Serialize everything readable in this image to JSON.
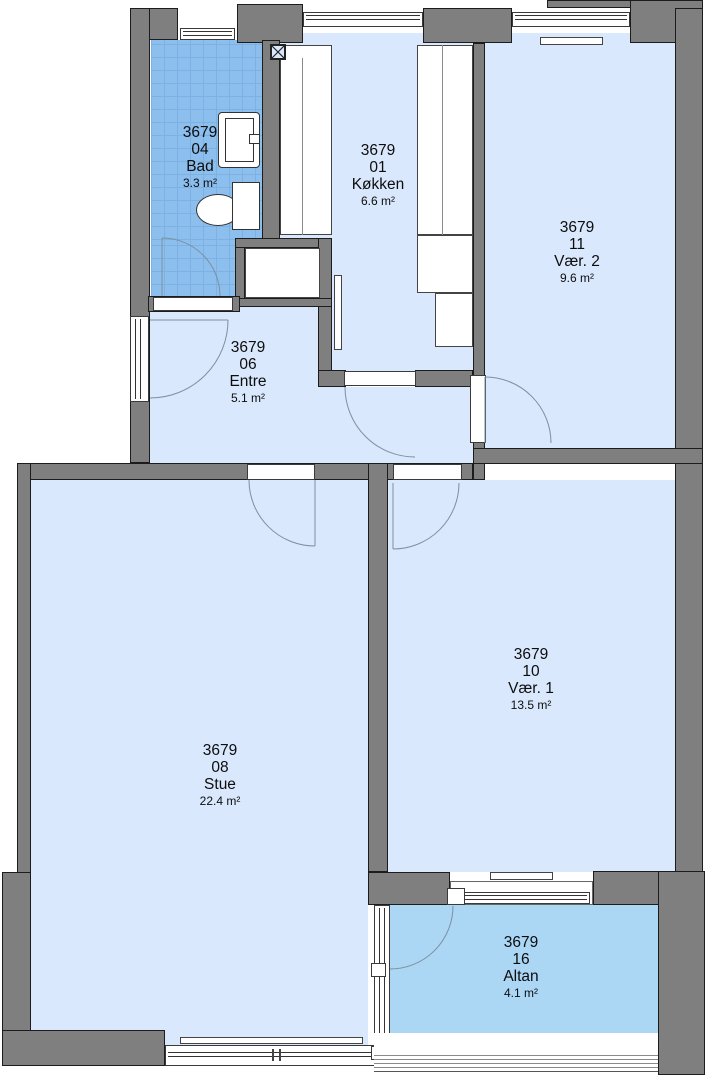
{
  "plan": {
    "unit_number": "3679",
    "rooms": {
      "bad": {
        "project": "3679",
        "number": "04",
        "name": "Bad",
        "area": "3.3 m²"
      },
      "kokken": {
        "project": "3679",
        "number": "01",
        "name": "Køkken",
        "area": "6.6 m²"
      },
      "vaer2": {
        "project": "3679",
        "number": "11",
        "name": "Vær. 2",
        "area": "9.6 m²"
      },
      "entre": {
        "project": "3679",
        "number": "06",
        "name": "Entre",
        "area": "5.1 m²"
      },
      "stue": {
        "project": "3679",
        "number": "08",
        "name": "Stue",
        "area": "22.4 m²"
      },
      "vaer1": {
        "project": "3679",
        "number": "10",
        "name": "Vær. 1",
        "area": "13.5 m²"
      },
      "altan": {
        "project": "3679",
        "number": "16",
        "name": "Altan",
        "area": "4.1 m²"
      }
    },
    "colors": {
      "wall": "#7f7f7f",
      "room_floor": "#d9e8fc",
      "bathroom_tile": "#8cbfee",
      "balcony_floor": "#abd7f5"
    }
  }
}
